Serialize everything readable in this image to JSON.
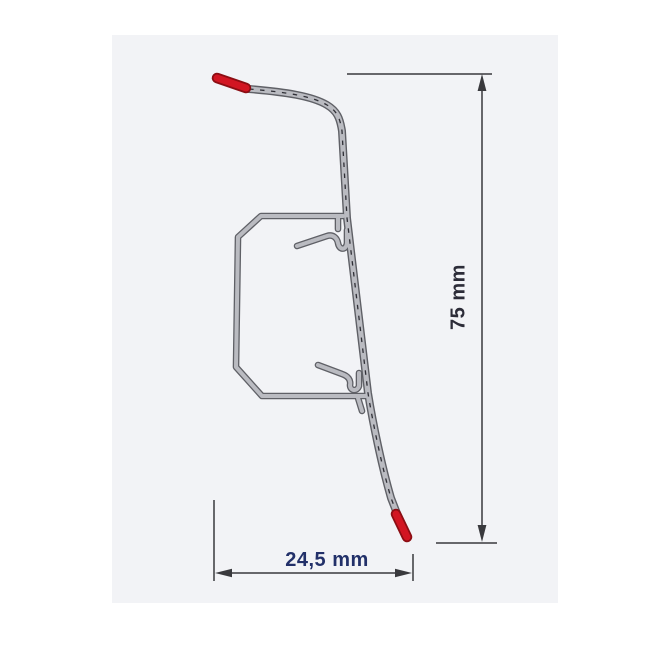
{
  "diagram": {
    "kind": "skirting-board-profile-cross-section",
    "labels": {
      "height": "75 mm",
      "width": "24,5 mm"
    },
    "colors": {
      "page_background": "#ffffff",
      "panel_background": "#f2f3f6",
      "profile_body": "#babbc1",
      "profile_outline": "#5f6066",
      "profile_hatch": "#2f2f36",
      "accent_red": "#d21522",
      "accent_red_outline": "#8c0d13",
      "dimension_line": "#39393d",
      "width_label_color": "#223069",
      "height_label_color": "#2c2c38"
    }
  }
}
